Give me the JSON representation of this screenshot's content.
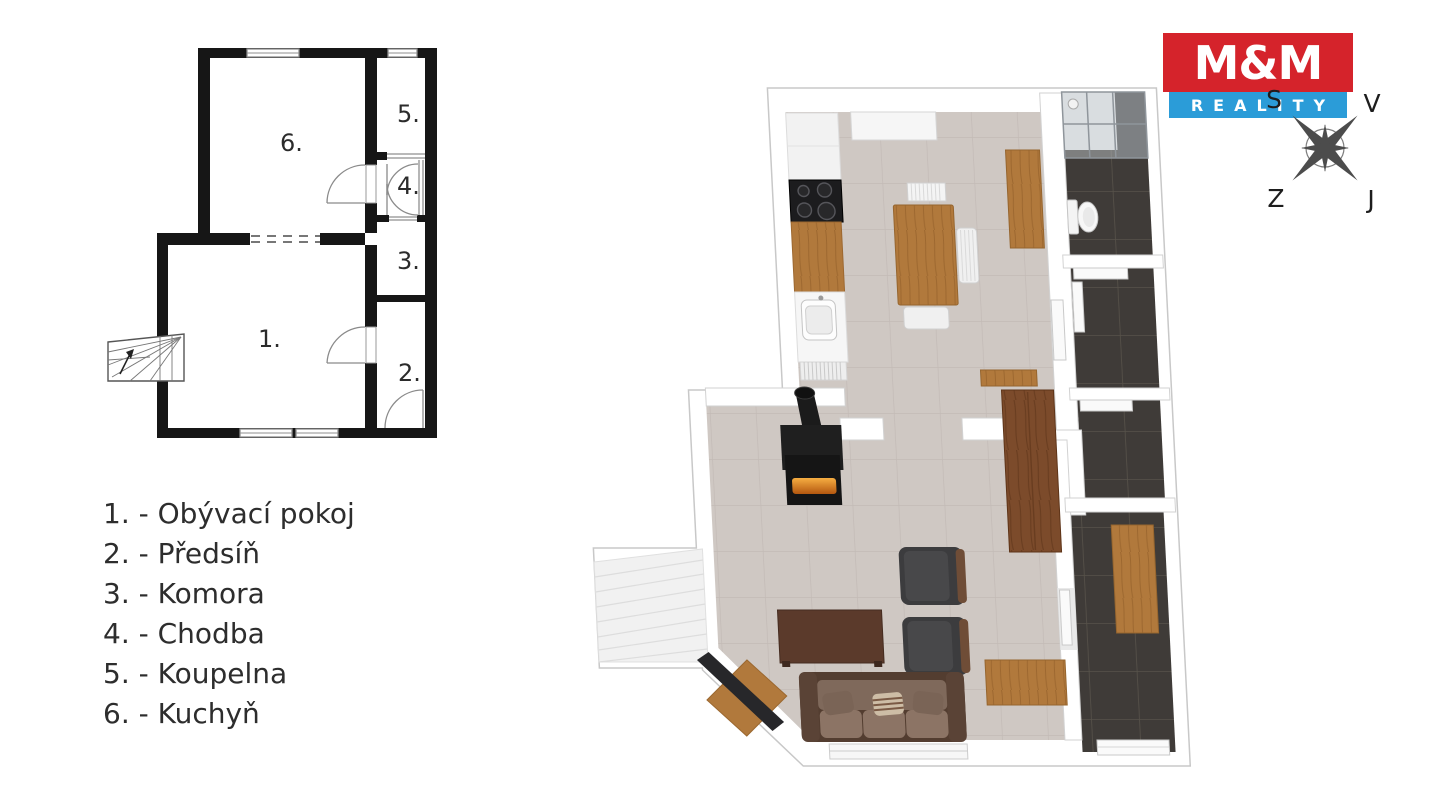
{
  "logo": {
    "top": "M&M",
    "bottom": "REALITY",
    "red": "#d5232b",
    "blue": "#2b9cd8"
  },
  "compass": {
    "north_label": "S",
    "east_label": "V",
    "west_label": "Z",
    "south_label": "J"
  },
  "floor_plan_2d": {
    "room_numbers": {
      "living": "1.",
      "hall": "2.",
      "pantry": "3.",
      "corridor": "4.",
      "bathroom": "5.",
      "kitchen": "6."
    }
  },
  "legend": {
    "items": [
      {
        "number": "1.",
        "name": "Obývací pokoj",
        "label": "1. - Obývací pokoj"
      },
      {
        "number": "2.",
        "name": "Předsíň",
        "label": "2. - Předsíň"
      },
      {
        "number": "3.",
        "name": "Komora",
        "label": "3. - Komora"
      },
      {
        "number": "4.",
        "name": "Chodba",
        "label": "4. - Chodba"
      },
      {
        "number": "5.",
        "name": "Koupelna",
        "label": "5. - Koupelna"
      },
      {
        "number": "6.",
        "name": "Kuchyň",
        "label": "6. - Kuchyň"
      }
    ]
  },
  "colors": {
    "wall_2d": "#161616",
    "thin_line_2d": "#8f8f8f",
    "floor_beige": "#cfc8c3",
    "floor_dark_tile": "#3f3b38",
    "wood_oak": "#b1793c",
    "wood_walnut": "#7c4b2b",
    "stove_black": "#161616",
    "compass_gray": "#4c4c4c"
  }
}
